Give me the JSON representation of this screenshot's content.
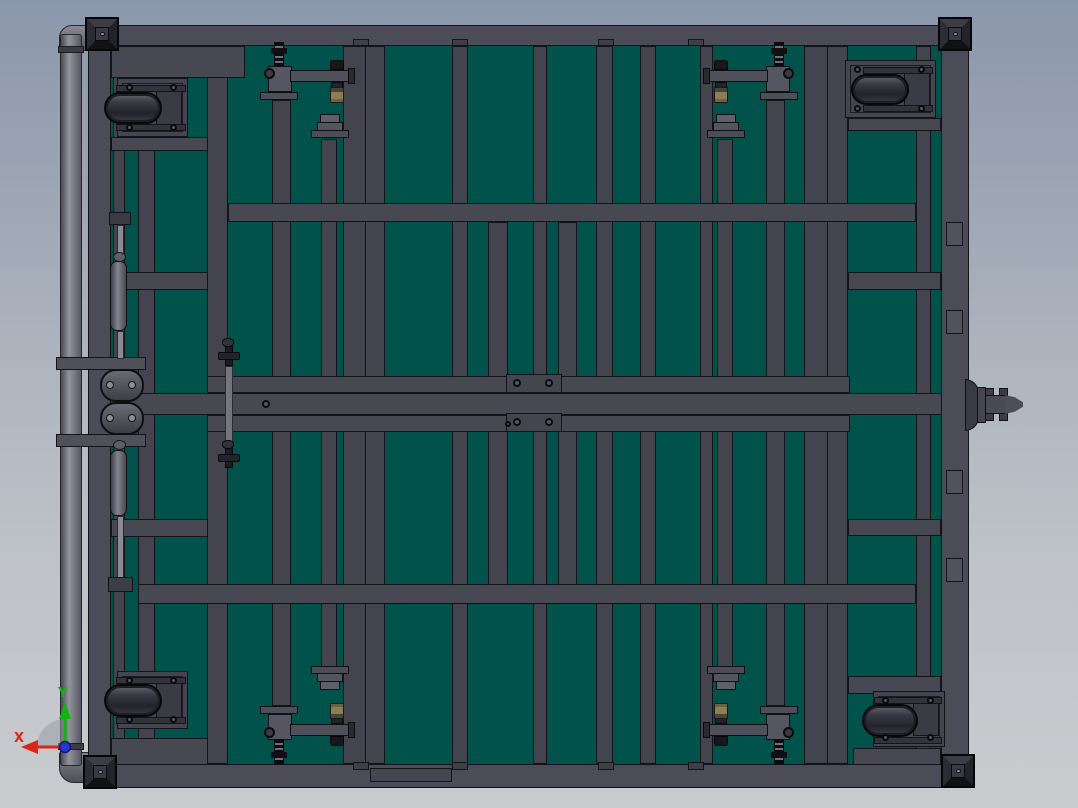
{
  "view": {
    "name": "cad-viewport",
    "triad": {
      "x_label": "X",
      "y_label": "Y"
    }
  },
  "palette": {
    "background_top": "#8b97ab",
    "background_bottom": "#c9cbce",
    "frame_beam": "#474752",
    "frame_rail": "#4c4c58",
    "panel_teal": "#00524a",
    "outline": "#13131a",
    "caster_wheel": "#34343e",
    "clamp_brass_tip": "#8b7c52",
    "handle_pipe": "#7b7b85",
    "corner_pad": "#2a2a33",
    "axis_x": "#dd2418",
    "axis_y": "#12b412",
    "axis_z": "#2636cf"
  },
  "parts": [
    "frame-rail",
    "frame-beam",
    "deck-panel",
    "swivel-caster",
    "toggle-clamp",
    "support-post-cap",
    "corner-foot-pad",
    "push-handle-pipe",
    "handle-hinge-bracket",
    "gas-spring",
    "valve-fitting",
    "tow-hitch",
    "orientation-triad"
  ]
}
